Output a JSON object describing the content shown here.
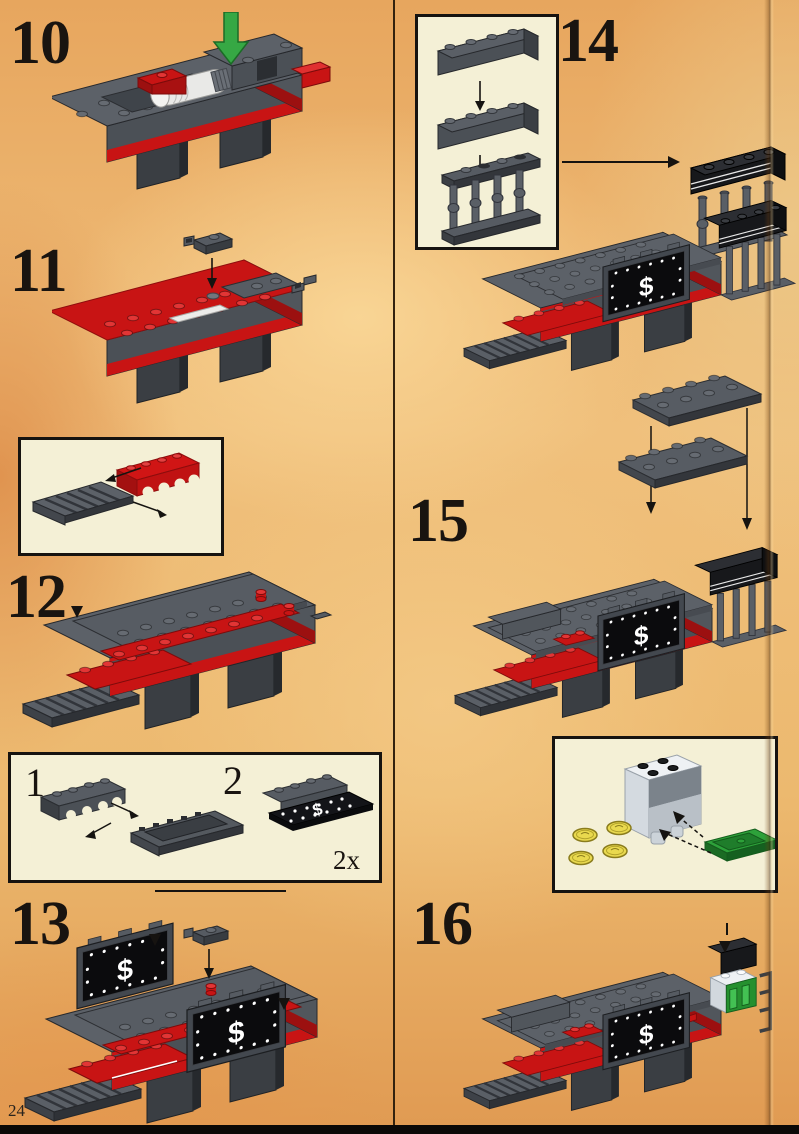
{
  "page": {
    "number": "24"
  },
  "steps": {
    "s10": {
      "number": "10"
    },
    "s11": {
      "number": "11"
    },
    "s12": {
      "number": "12"
    },
    "s13": {
      "number": "13"
    },
    "s14": {
      "number": "14"
    },
    "s15": {
      "number": "15"
    },
    "s16": {
      "number": "16"
    }
  },
  "parts_callout": {
    "item1_label": "1",
    "item2_label": "2",
    "quantity": "2x"
  },
  "decals": {
    "money_panel_symbol": "$"
  },
  "colors": {
    "background": "#ecb76d",
    "callout_box_bg": "#f4f0d6",
    "lego_dark_gray": "#4b5056",
    "lego_red": "#c81414",
    "lego_black": "#17181b",
    "arrow_green": "#36a844",
    "coin_yellow": "#e9d94e",
    "container_white": "#eef1f4",
    "door_green": "#2da13a"
  }
}
